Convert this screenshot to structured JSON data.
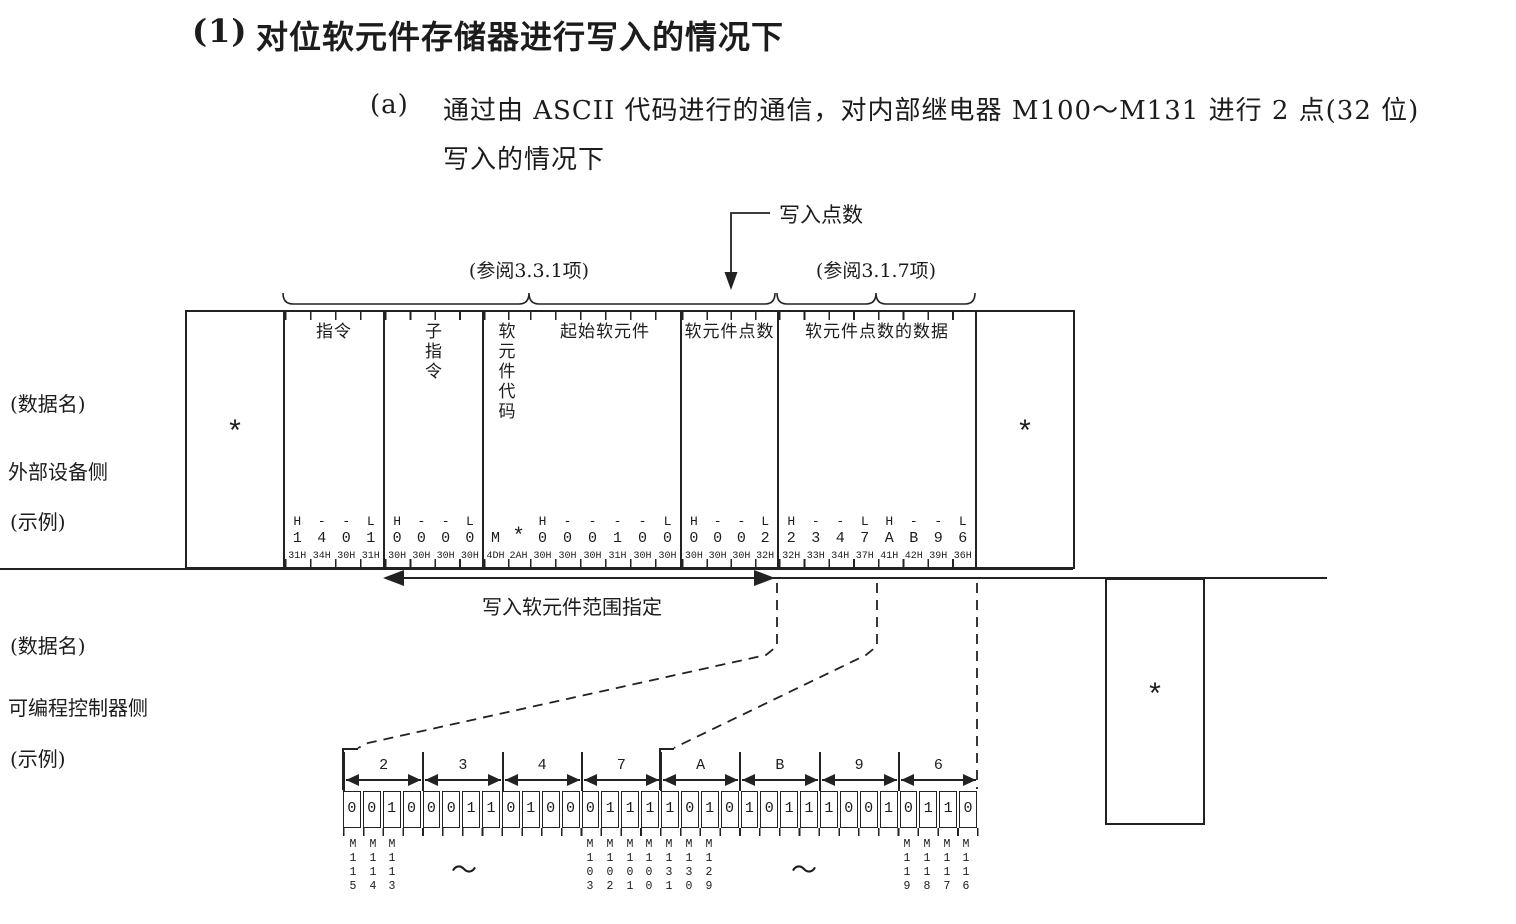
{
  "ink_color": "#1c1c1c",
  "title": {
    "marker": "(1)",
    "text": "对位软元件存储器进行写入的情况下"
  },
  "subtitle": {
    "marker": "(a)",
    "line1": "通过由 ASCII 代码进行的通信，对内部继电器 M100～M131 进行 2 点(32 位)",
    "line2": "写入的情况下"
  },
  "annotations": {
    "write_points_label": "写入点数",
    "ref_left": "(参阅3.3.1项)",
    "ref_right": "(参阅3.1.7项)",
    "write_range_label": "写入软元件范围指定"
  },
  "external_side": {
    "row_labels": [
      "(数据名)",
      "外部设备侧",
      "(示例)"
    ],
    "left_asterisk": "*",
    "right_asterisk": "*",
    "columns": [
      {
        "header": "指令",
        "hl": [
          "H",
          "-",
          "-",
          "L"
        ],
        "chars": [
          "1",
          "4",
          "0",
          "1"
        ],
        "hex": [
          "31H",
          "34H",
          "30H",
          "31H"
        ]
      },
      {
        "header": "子指令",
        "hl": [
          "H",
          "-",
          "-",
          "L"
        ],
        "chars": [
          "0",
          "0",
          "0",
          "0"
        ],
        "hex": [
          "30H",
          "30H",
          "30H",
          "30H"
        ]
      },
      {
        "header": "软元件代码",
        "hl": [
          "",
          ""
        ],
        "chars": [
          "M",
          "*"
        ],
        "hex": [
          "4DH",
          "2AH"
        ]
      },
      {
        "header": "起始软元件",
        "hl": [
          "H",
          "-",
          "-",
          "-",
          "-",
          "L"
        ],
        "chars": [
          "0",
          "0",
          "0",
          "1",
          "0",
          "0"
        ],
        "hex": [
          "30H",
          "30H",
          "30H",
          "31H",
          "30H",
          "30H"
        ]
      },
      {
        "header": "软元件点数",
        "hl": [
          "H",
          "-",
          "-",
          "L"
        ],
        "chars": [
          "0",
          "0",
          "0",
          "2"
        ],
        "hex": [
          "30H",
          "30H",
          "30H",
          "32H"
        ]
      },
      {
        "header": "软元件点数的数据",
        "hl": [
          "H",
          "-",
          "-",
          "L",
          "H",
          "-",
          "-",
          "L"
        ],
        "chars": [
          "2",
          "3",
          "4",
          "7",
          "A",
          "B",
          "9",
          "6"
        ],
        "hex": [
          "32H",
          "33H",
          "34H",
          "37H",
          "41H",
          "42H",
          "39H",
          "36H"
        ]
      }
    ]
  },
  "plc_side": {
    "row_labels": [
      "(数据名)",
      "可编程控制器侧",
      "(示例)"
    ],
    "asterisk": "*",
    "tilde": "～",
    "groups": [
      {
        "label": "2",
        "bits": [
          "0",
          "0",
          "1",
          "0"
        ]
      },
      {
        "label": "3",
        "bits": [
          "0",
          "0",
          "1",
          "1"
        ]
      },
      {
        "label": "4",
        "bits": [
          "0",
          "1",
          "0",
          "0"
        ]
      },
      {
        "label": "7",
        "bits": [
          "0",
          "1",
          "1",
          "1"
        ]
      },
      {
        "label": "A",
        "bits": [
          "1",
          "0",
          "1",
          "0"
        ]
      },
      {
        "label": "B",
        "bits": [
          "1",
          "0",
          "1",
          "1"
        ]
      },
      {
        "label": "9",
        "bits": [
          "1",
          "0",
          "0",
          "1"
        ]
      },
      {
        "label": "6",
        "bits": [
          "0",
          "1",
          "1",
          "0"
        ]
      }
    ],
    "device_labels_left": [
      "M115",
      "M114",
      "M113"
    ],
    "device_labels_mid": [
      "M103",
      "M102",
      "M101",
      "M100",
      "M131",
      "M130",
      "M129"
    ],
    "device_labels_right": [
      "M119",
      "M118",
      "M117",
      "M116"
    ]
  }
}
